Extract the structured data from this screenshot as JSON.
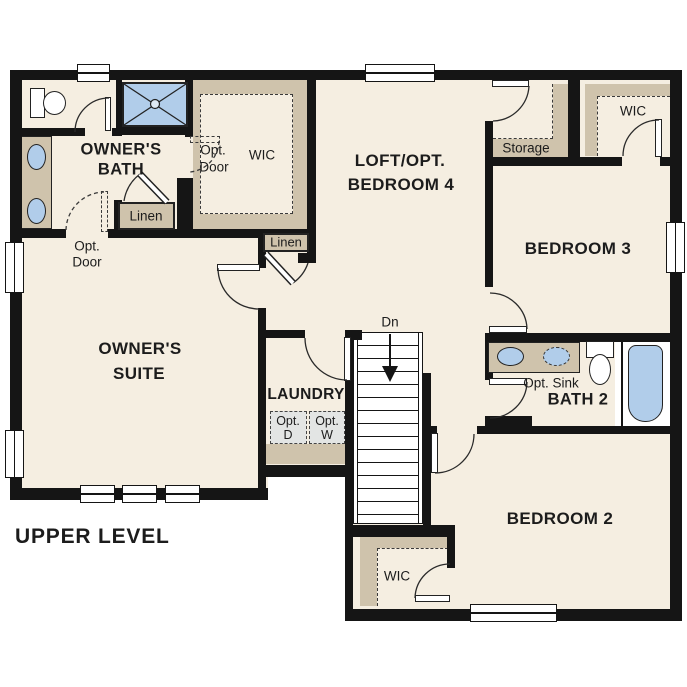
{
  "title": "UPPER LEVEL",
  "rooms": {
    "owners_bath": {
      "line1": "OWNER'S",
      "line2": "BATH"
    },
    "owners_suite": {
      "line1": "OWNER'S",
      "line2": "SUITE"
    },
    "loft": {
      "line1": "LOFT/OPT.",
      "line2": "BEDROOM 4"
    },
    "bedroom3": {
      "label": "BEDROOM 3"
    },
    "bedroom2": {
      "label": "BEDROOM 2"
    },
    "bath2": {
      "label": "BATH 2"
    },
    "laundry": {
      "label": "LAUNDRY"
    },
    "storage": {
      "label": "Storage"
    },
    "wic_owners": {
      "label": "WIC"
    },
    "wic_bedroom3": {
      "label": "WIC"
    },
    "wic_bedroom2": {
      "label": "WIC"
    }
  },
  "closets": {
    "linen_bath": "Linen",
    "linen_hall": "Linen"
  },
  "annotations": {
    "opt_door_wic": {
      "line1": "Opt.",
      "line2": "Door"
    },
    "opt_door_suite": {
      "line1": "Opt.",
      "line2": "Door"
    },
    "opt_sink": "Opt. Sink",
    "opt_dryer": {
      "line1": "Opt.",
      "line2": "D"
    },
    "opt_washer": {
      "line1": "Opt.",
      "line2": "W"
    },
    "stair_direction": "Dn"
  },
  "colors": {
    "floor": "#f5eee1",
    "accent_tan": "#cfc3ac",
    "fixture_blue": "#b1cdea",
    "appliance_gray": "#e3e5e4",
    "wall": "#151515"
  }
}
